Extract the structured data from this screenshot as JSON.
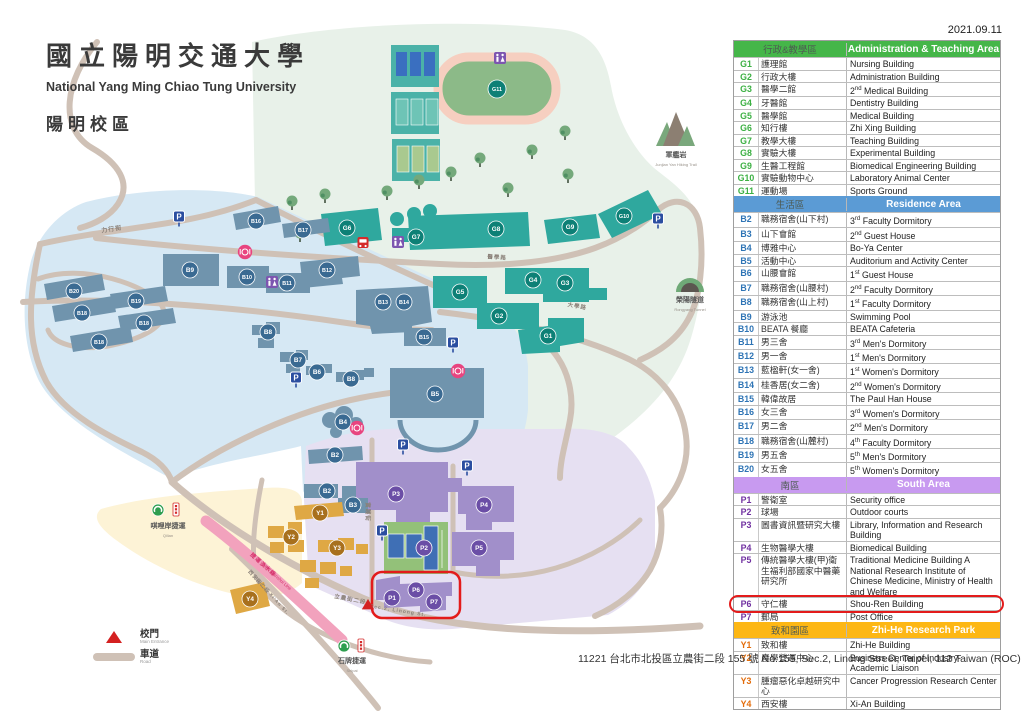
{
  "date": "2021.09.11",
  "title": {
    "zh": "國立陽明交通大學",
    "en": "National Yang Ming Chiao Tung University",
    "campus": "陽明校區"
  },
  "address": "11221 台北市北投區立農街二段 155 號  No.155, Sec.2, Linong Street, Taipei, 112 Taiwan (ROC)",
  "key": {
    "entrance_zh": "校門",
    "entrance_en": "Main Entrance",
    "road_zh": "車道",
    "road_en": "Road"
  },
  "landmarks": {
    "mountain_zh": "軍艦岩",
    "mountain_en": "Junjian Yan Hiking Trail",
    "tunnel_zh": "榮陽隧道",
    "tunnel_en": "Rongyang Tunnel",
    "qilian_zh": "唭哩岸捷運",
    "qilian_en": "Qilian",
    "shipai_zh": "石牌捷運",
    "shipai_en": "Shipai",
    "mrt_zh": "捷運淡水線",
    "mrt_en": "MRT Danshui Line"
  },
  "colors": {
    "badge": {
      "g": "#0d8076",
      "b": "#3a6a92",
      "p": "#6b4ea6",
      "y": "#a8701d"
    },
    "bgroup": {
      "g": "#2fa89e",
      "b": "#7094ad",
      "p": "#a18fca",
      "y": "#dfa844"
    },
    "zones": {
      "teaching": "#e8f1e9",
      "residence": "#d6e8f4",
      "south": "#e6e0f2",
      "zhihe": "#fdf3d6"
    },
    "road": "#cfc1b6",
    "mrt": "#f2a2bd",
    "highlight": "#e31b1b"
  },
  "map": {
    "badges": [
      {
        "label": "G1",
        "group": "g",
        "x": 548,
        "y": 336
      },
      {
        "label": "G2",
        "group": "g",
        "x": 499,
        "y": 316
      },
      {
        "label": "G3",
        "group": "g",
        "x": 565,
        "y": 283
      },
      {
        "label": "G4",
        "group": "g",
        "x": 533,
        "y": 280
      },
      {
        "label": "G5",
        "group": "g",
        "x": 460,
        "y": 292
      },
      {
        "label": "G6",
        "group": "g",
        "x": 347,
        "y": 228
      },
      {
        "label": "G7",
        "group": "g",
        "x": 416,
        "y": 237
      },
      {
        "label": "G8",
        "group": "g",
        "x": 496,
        "y": 229
      },
      {
        "label": "G9",
        "group": "g",
        "x": 570,
        "y": 227
      },
      {
        "label": "G10",
        "group": "g",
        "x": 624,
        "y": 216
      },
      {
        "label": "G11",
        "group": "g",
        "x": 497,
        "y": 89
      },
      {
        "label": "B2",
        "group": "b",
        "x": 335,
        "y": 455
      },
      {
        "label": "B2",
        "group": "b",
        "x": 327,
        "y": 491
      },
      {
        "label": "B3",
        "group": "b",
        "x": 353,
        "y": 505
      },
      {
        "label": "B4",
        "group": "b",
        "x": 343,
        "y": 422
      },
      {
        "label": "B5",
        "group": "b",
        "x": 435,
        "y": 394
      },
      {
        "label": "B6",
        "group": "b",
        "x": 317,
        "y": 372
      },
      {
        "label": "B7",
        "group": "b",
        "x": 298,
        "y": 360
      },
      {
        "label": "B8",
        "group": "b",
        "x": 268,
        "y": 332
      },
      {
        "label": "B8",
        "group": "b",
        "x": 351,
        "y": 379
      },
      {
        "label": "B9",
        "group": "b",
        "x": 190,
        "y": 270
      },
      {
        "label": "B10",
        "group": "b",
        "x": 247,
        "y": 277
      },
      {
        "label": "B11",
        "group": "b",
        "x": 287,
        "y": 283
      },
      {
        "label": "B12",
        "group": "b",
        "x": 327,
        "y": 270
      },
      {
        "label": "B13",
        "group": "b",
        "x": 383,
        "y": 302
      },
      {
        "label": "B14",
        "group": "b",
        "x": 404,
        "y": 302
      },
      {
        "label": "B15",
        "group": "b",
        "x": 424,
        "y": 337
      },
      {
        "label": "B16",
        "group": "b",
        "x": 256,
        "y": 221
      },
      {
        "label": "B17",
        "group": "b",
        "x": 303,
        "y": 230
      },
      {
        "label": "B18",
        "group": "b",
        "x": 82,
        "y": 313
      },
      {
        "label": "B18",
        "group": "b",
        "x": 144,
        "y": 323
      },
      {
        "label": "B18",
        "group": "b",
        "x": 99,
        "y": 342
      },
      {
        "label": "B19",
        "group": "b",
        "x": 136,
        "y": 301
      },
      {
        "label": "B20",
        "group": "b",
        "x": 74,
        "y": 291
      },
      {
        "label": "P1",
        "group": "p",
        "x": 392,
        "y": 598
      },
      {
        "label": "P2",
        "group": "p",
        "x": 424,
        "y": 548
      },
      {
        "label": "P3",
        "group": "p",
        "x": 396,
        "y": 494
      },
      {
        "label": "P4",
        "group": "p",
        "x": 484,
        "y": 505
      },
      {
        "label": "P5",
        "group": "p",
        "x": 479,
        "y": 548
      },
      {
        "label": "P6",
        "group": "p",
        "x": 416,
        "y": 590
      },
      {
        "label": "P7",
        "group": "p",
        "x": 434,
        "y": 602
      },
      {
        "label": "Y1",
        "group": "y",
        "x": 320,
        "y": 513
      },
      {
        "label": "Y2",
        "group": "y",
        "x": 291,
        "y": 537
      },
      {
        "label": "Y3",
        "group": "y",
        "x": 337,
        "y": 548
      },
      {
        "label": "Y4",
        "group": "y",
        "x": 250,
        "y": 599
      }
    ],
    "icons": {
      "parking": [
        [
          179,
          222
        ],
        [
          658,
          224
        ],
        [
          453,
          348
        ],
        [
          296,
          383
        ],
        [
          403,
          450
        ],
        [
          467,
          471
        ],
        [
          382,
          536
        ]
      ],
      "wc": [
        [
          500,
          58
        ],
        [
          272,
          282
        ],
        [
          398,
          242
        ]
      ],
      "restaurant": [
        [
          245,
          252
        ],
        [
          458,
          371
        ],
        [
          357,
          428
        ]
      ],
      "bus": [
        [
          363,
          243
        ]
      ],
      "entrance": [
        [
          368,
          605
        ]
      ]
    },
    "trees": [
      [
        292,
        201
      ],
      [
        325,
        194
      ],
      [
        356,
        216
      ],
      [
        387,
        191
      ],
      [
        419,
        180
      ],
      [
        451,
        172
      ],
      [
        480,
        158
      ],
      [
        508,
        188
      ],
      [
        532,
        150
      ],
      [
        565,
        131
      ],
      [
        568,
        174
      ],
      [
        300,
        233
      ]
    ],
    "streets": [
      {
        "t": "力行街",
        "x": 112,
        "y": 231,
        "r": -8,
        "s": 6
      },
      {
        "t": "醫學路",
        "x": 497,
        "y": 259,
        "r": 4,
        "s": 5.5
      },
      {
        "t": "大學路",
        "x": 577,
        "y": 308,
        "r": 10,
        "s": 5.5
      },
      {
        "t": "實踐街",
        "x": 366,
        "y": 512,
        "r": 90,
        "s": 5.5
      },
      {
        "t": "立農街二段",
        "x": 350,
        "y": 601,
        "r": 11,
        "s": 5.5
      },
      {
        "t": "Sec.2, Linong St.",
        "x": 398,
        "y": 612,
        "r": 9,
        "s": 5
      },
      {
        "t": "西安街二段",
        "x": 258,
        "y": 583,
        "r": 48,
        "s": 5
      },
      {
        "t": "Sec.2, Xi'An St.",
        "x": 271,
        "y": 597,
        "r": 48,
        "s": 4.5
      }
    ]
  },
  "table": {
    "sections": [
      {
        "zh": "行政&教學區",
        "en": "Administration & Teaching Area",
        "color": "#45b649",
        "code_color": "#3cb043",
        "rows": [
          [
            "G1",
            "護理館",
            "Nursing Building"
          ],
          [
            "G2",
            "行政大樓",
            "Administration Building"
          ],
          [
            "G3",
            "醫學二館",
            "2nd Medical Building"
          ],
          [
            "G4",
            "牙醫館",
            "Dentistry Building"
          ],
          [
            "G5",
            "醫學館",
            "Medical Building"
          ],
          [
            "G6",
            "知行樓",
            "Zhi Xing Building"
          ],
          [
            "G7",
            "教學大樓",
            "Teaching Building"
          ],
          [
            "G8",
            "實驗大樓",
            "Experimental Building"
          ],
          [
            "G9",
            "生醫工程館",
            "Biomedical Engineering Building"
          ],
          [
            "G10",
            "實驗動物中心",
            "Laboratory Animal Center"
          ],
          [
            "G11",
            "運動場",
            "Sports Ground"
          ]
        ]
      },
      {
        "zh": "生活區",
        "en": "Residence Area",
        "color": "#5b9bd5",
        "code_color": "#2e74b5",
        "rows": [
          [
            "B2",
            "職務宿舍(山下村)",
            "3rd Faculty Dormitory"
          ],
          [
            "B3",
            "山下會館",
            "2nd Guest House"
          ],
          [
            "B4",
            "博雅中心",
            "Bo-Ya Center"
          ],
          [
            "B5",
            "活動中心",
            "Auditorium and Activity Center"
          ],
          [
            "B6",
            "山腰會館",
            "1st Guest House"
          ],
          [
            "B7",
            "職務宿舍(山腰村)",
            "2nd Faculty Dormitory"
          ],
          [
            "B8",
            "職務宿舍(山上村)",
            "1st Faculty Dormitory"
          ],
          [
            "B9",
            "游泳池",
            "Swimming Pool"
          ],
          [
            "B10",
            "BEATA 餐廳",
            "BEATA Cafeteria"
          ],
          [
            "B11",
            "男三舍",
            "3rd Men's Dormitory"
          ],
          [
            "B12",
            "男一舍",
            "1st Men's Dormitory"
          ],
          [
            "B13",
            "藍楹軒(女一舍)",
            "1st Women's Dormitory"
          ],
          [
            "B14",
            "桂香居(女二舍)",
            "2nd Women's Dormitory"
          ],
          [
            "B15",
            "韓偉故居",
            "The Paul Han House"
          ],
          [
            "B16",
            "女三舍",
            "3rd Women's Dormitory"
          ],
          [
            "B17",
            "男二舍",
            "2nd Men's Dormitory"
          ],
          [
            "B18",
            "職務宿舍(山麓村)",
            "4th Faculty Dormitory"
          ],
          [
            "B19",
            "男五舍",
            "5th Men's Dormitory"
          ],
          [
            "B20",
            "女五舍",
            "5th Women's Dormitory"
          ]
        ]
      },
      {
        "zh": "南區",
        "en": "South Area",
        "color": "#c89af0",
        "code_color": "#7030a0",
        "rows": [
          [
            "P1",
            "警衛室",
            "Security office"
          ],
          [
            "P2",
            "球場",
            "Outdoor courts"
          ],
          [
            "P3",
            "圖書資訊暨研究大樓",
            "Library, Information and Research Building"
          ],
          [
            "P4",
            "生物醫學大樓",
            "Biomedical Building"
          ],
          [
            "P5",
            "傳統醫學大樓(甲)衛生福利部國家中醫藥研究所",
            "Traditional Medicine Building A National Research Institute of Chinese Medicine, Ministry of Health and Welfare"
          ],
          [
            "P6",
            "守仁樓",
            "Shou-Ren Building",
            true
          ],
          [
            "P7",
            "郵局",
            "Post Office"
          ]
        ]
      },
      {
        "zh": "致和園區",
        "en": "Zhi-He Research Park",
        "color": "#fdb714",
        "code_color": "#e36c0a",
        "rows": [
          [
            "Y1",
            "致和樓",
            "Zhi-He Building"
          ],
          [
            "Y2",
            "產學營運中心",
            "Business Center of Industry-Academic Liaison"
          ],
          [
            "Y3",
            "腫瘤惡化卓越研究中心",
            "Cancer Progression Research Center"
          ],
          [
            "Y4",
            "西安樓",
            "Xi-An Building"
          ]
        ]
      }
    ]
  }
}
